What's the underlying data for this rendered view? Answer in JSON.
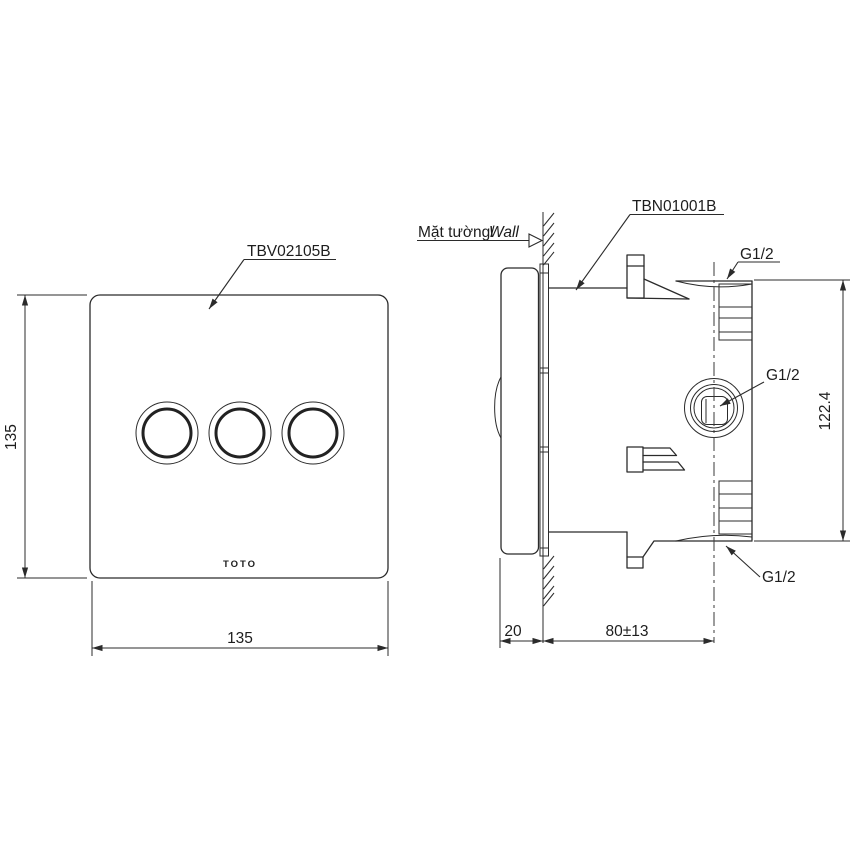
{
  "drawing": {
    "front_view": {
      "part_label": "TBV02105B",
      "logo": "TOTO",
      "dim_width": "135",
      "dim_height": "135"
    },
    "side_view": {
      "part_label": "TBN01001B",
      "wall_label_vi": "Mặt tường/",
      "wall_label_en": "Wall",
      "port_top_label": "G1/2",
      "port_mid_label": "G1/2",
      "port_bottom_label": "G1/2",
      "dim_height": "122.4",
      "dim_wall_thickness": "20",
      "dim_depth": "80±13"
    },
    "colors": {
      "line": "#2b2b2b",
      "background": "#ffffff"
    }
  }
}
